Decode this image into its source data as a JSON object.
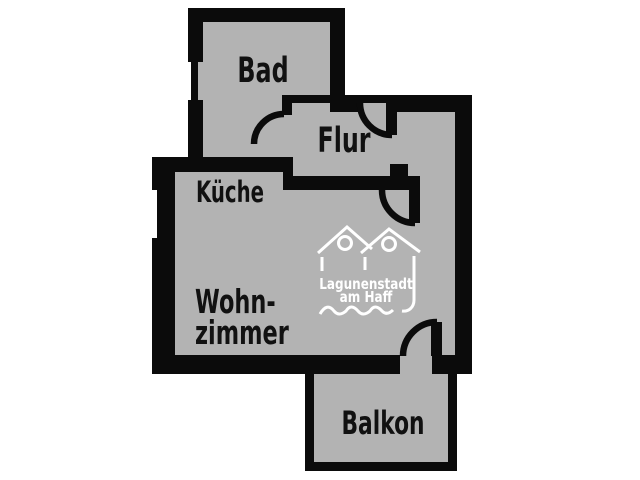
{
  "colors": {
    "background": "#ffffff",
    "floor": "#b3b3b3",
    "wall": "#0b0b0b",
    "label": "#111111",
    "logo": "#ffffff"
  },
  "rooms": {
    "bad": {
      "label": "Bad"
    },
    "flur": {
      "label": "Flur"
    },
    "kueche": {
      "label": "Küche"
    },
    "wohnzimmer": {
      "label_line1": "Wohn-",
      "label_line2": "zimmer"
    },
    "balkon": {
      "label": "Balkon"
    }
  },
  "logo": {
    "line1": "Lagunenstadt",
    "line2": "am Haff"
  }
}
